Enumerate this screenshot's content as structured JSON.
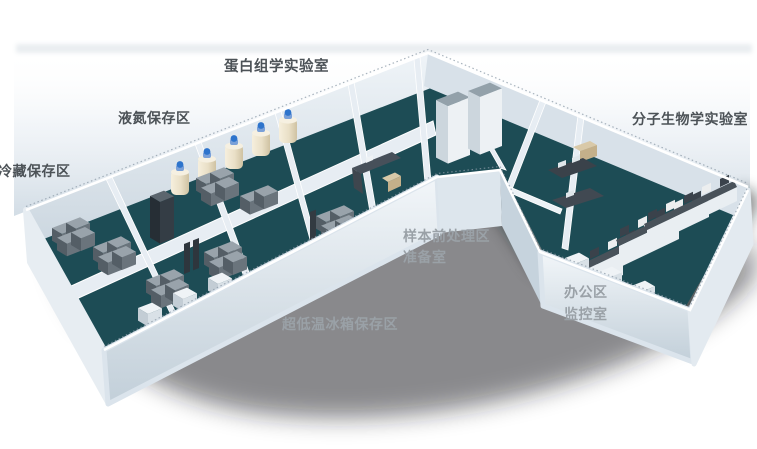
{
  "scene": {
    "description": "3D isometric floor plan of a biobank laboratory",
    "colors": {
      "background": "#ffffff",
      "floor_teal": "#1d4c55",
      "walls": "#e8eef4",
      "wall_shade": "#c3d0da",
      "back_glow": "#d2dce5",
      "drop_shadow": "#14191e",
      "freezer_gray": "#6a747c",
      "freezer_top": "#99a3ab",
      "ln2_tank_body": "#e9dfc6",
      "ln2_tank_cap": "#2e74cc",
      "bench_top": "#49525a",
      "label_dark": "#4c5257",
      "label_light": "#9aa1a7"
    }
  },
  "labels": {
    "proteomics_lab": "蛋白组学实验室",
    "liquid_nitrogen_area": "液氮保存区",
    "cold_storage_area": "冷藏保存区",
    "molecular_biology_lab": "分子生物学实验室",
    "sample_pretreatment_area": "样本前处理区",
    "preparation_room": "准备室",
    "office_area": "办公区",
    "monitoring_room": "监控室",
    "ult_freezer_area": "超低温冰箱保存区"
  }
}
